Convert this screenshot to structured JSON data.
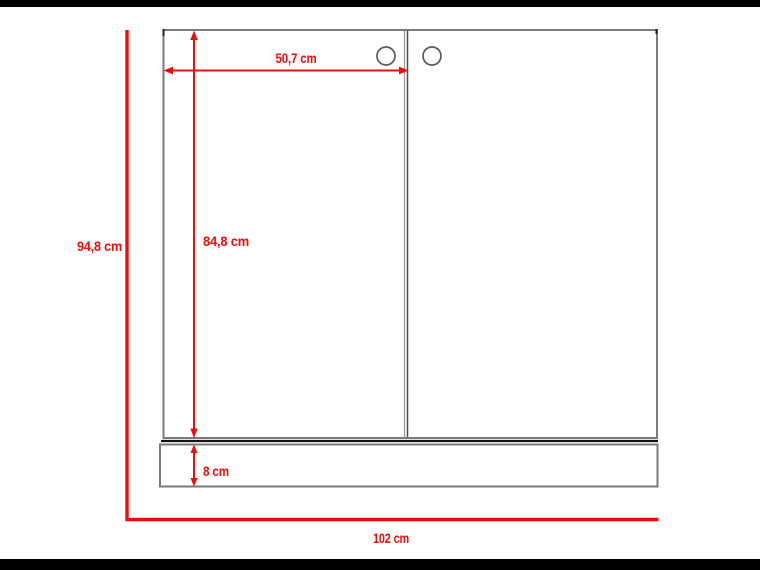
{
  "diagram": {
    "kind": "furniture-dimension-drawing",
    "subject": "two-door cabinet, front elevation with plinth base",
    "units": "cm",
    "labels": {
      "overall_height": "94,8 cm",
      "door_height": "84,8 cm",
      "door_width": "50,7 cm",
      "plinth_height": "8 cm",
      "overall_width": "102 cm"
    },
    "values": {
      "overall_height_cm": 94.8,
      "door_height_cm": 84.8,
      "door_width_cm": 50.7,
      "plinth_height_cm": 8,
      "overall_width_cm": 102
    },
    "features": {
      "doors": 2,
      "knobs": 2
    },
    "colors": {
      "dimension_red": "#f10c0c",
      "outline_gray": "#7a7a7a",
      "letterbox_black": "#000000",
      "background": "#ffffff"
    }
  }
}
